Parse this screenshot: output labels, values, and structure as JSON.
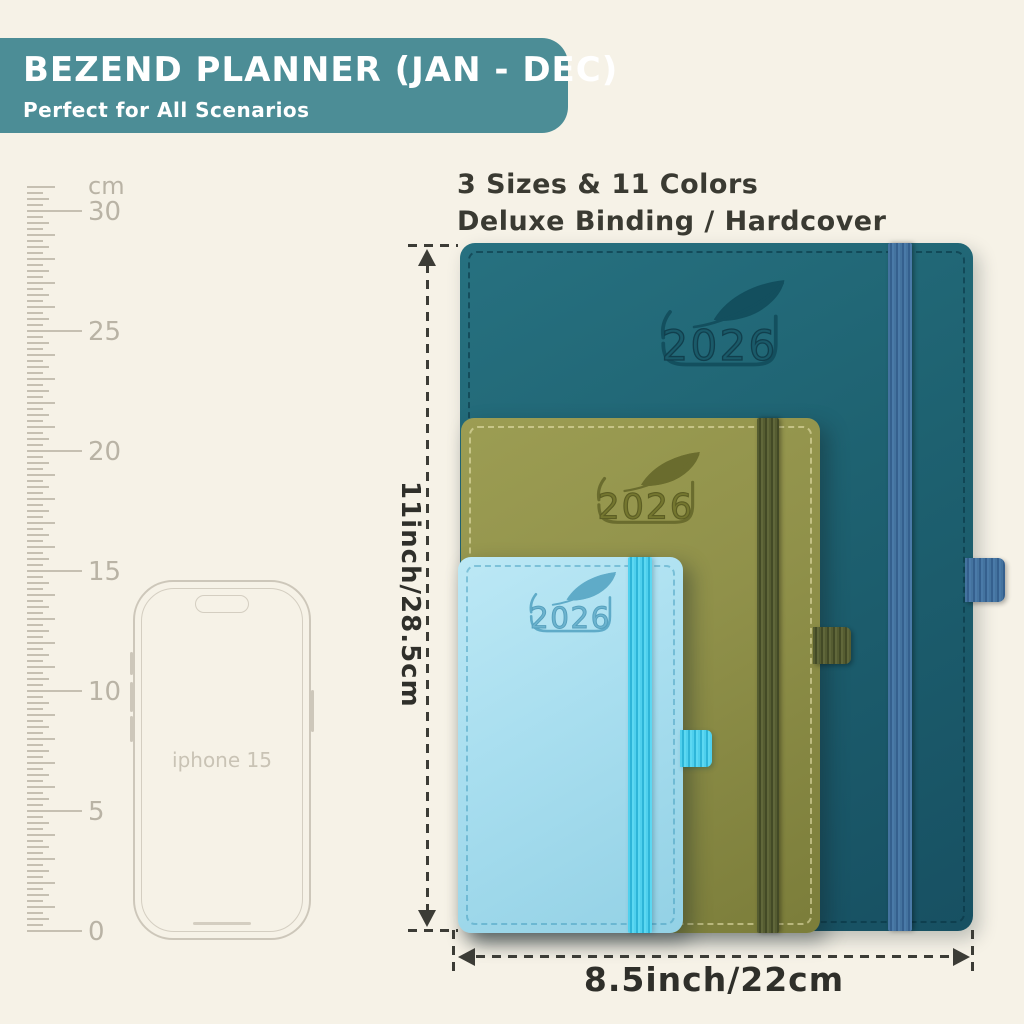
{
  "banner": {
    "title": "BEZEND PLANNER (JAN - DEC)",
    "subtitle": "Perfect for All Scenarios",
    "bg_color": "#4c8d96",
    "text_color": "#ffffff"
  },
  "features": {
    "line1": "3 Sizes & 11 Colors",
    "line2": "Deluxe Binding / Hardcover"
  },
  "ruler": {
    "unit": "cm",
    "labels": [
      30,
      25,
      20,
      15,
      10,
      5,
      0
    ]
  },
  "phone": {
    "label": "iphone 15"
  },
  "dimensions": {
    "height_label": "11inch/28.5cm",
    "width_label": "8.5inch/22cm"
  },
  "notebooks": [
    {
      "name": "large-planner",
      "year": "2026",
      "cover_color": "#1e6271",
      "band_color": "#3f6da1",
      "size": "8.5 x 11 in"
    },
    {
      "name": "medium-planner",
      "year": "2026",
      "cover_color": "#90914a",
      "band_color": "#535a30"
    },
    {
      "name": "small-planner",
      "year": "2026",
      "cover_color": "#a8deef",
      "band_color": "#3ec7e6"
    }
  ],
  "colors": {
    "background": "#f6f2e7",
    "annotation": "#3c3c36",
    "ruler_gray": "#c6c0b2"
  }
}
